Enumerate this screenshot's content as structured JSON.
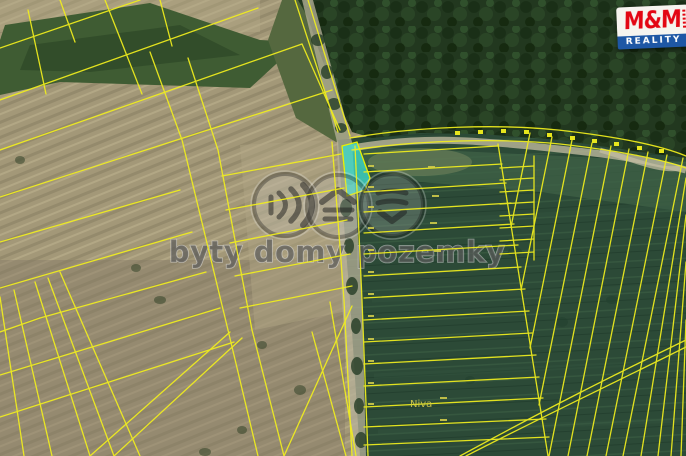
{
  "map": {
    "kind": "satellite cadastral map",
    "place_label": "Niva",
    "line_color": "#f2ef1d",
    "highlight_color": "#3fd9c8"
  },
  "watermark": {
    "text": "byty domy pozemky",
    "icons": [
      "waves-right-icon",
      "roof-over-lines-icon",
      "stacked-layers-icon"
    ]
  },
  "logo": {
    "title": "M&M",
    "subtitle": "REALITY",
    "red": "#e30613",
    "blue": "#1e57a5"
  }
}
